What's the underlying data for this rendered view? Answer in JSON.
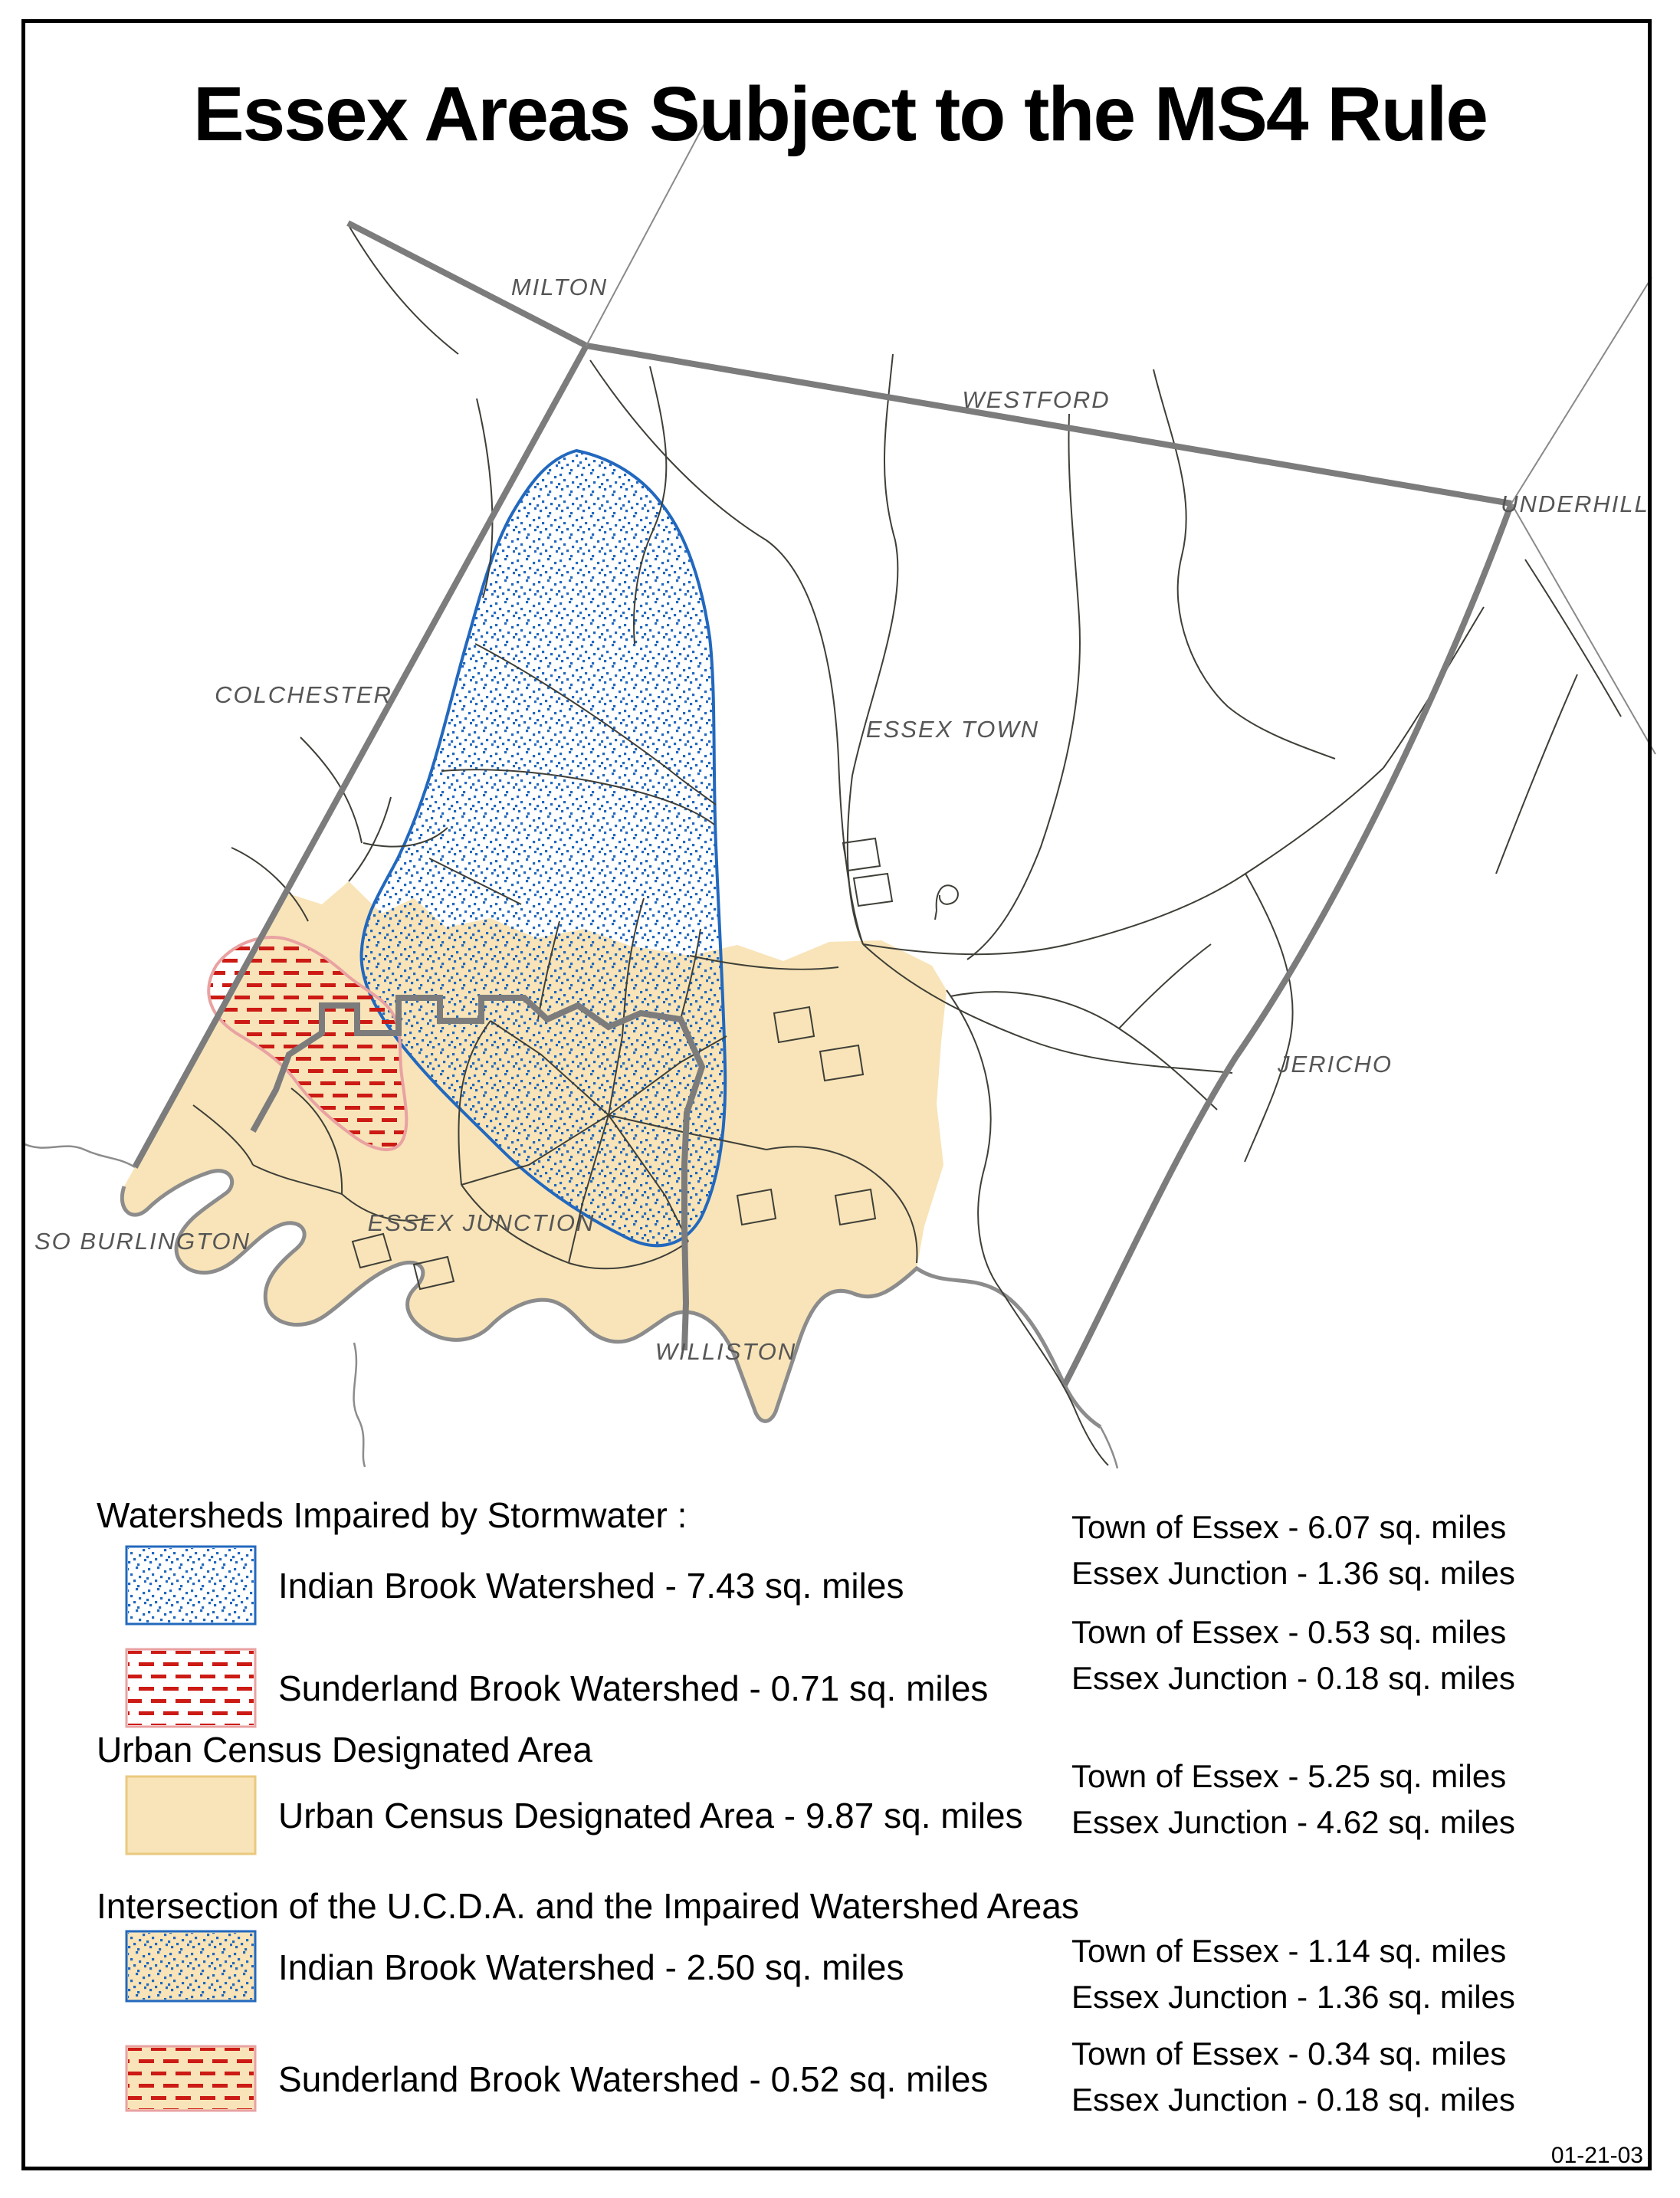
{
  "page": {
    "title": "Essex Areas Subject to the MS4 Rule",
    "date_stamp": "01-21-03"
  },
  "map": {
    "town_labels": [
      {
        "id": "milton",
        "text": "MILTON"
      },
      {
        "id": "westford",
        "text": "WESTFORD"
      },
      {
        "id": "underhill",
        "text": "UNDERHILL"
      },
      {
        "id": "colchester",
        "text": "COLCHESTER"
      },
      {
        "id": "essex-town",
        "text": "ESSEX TOWN"
      },
      {
        "id": "jericho",
        "text": "JERICHO"
      },
      {
        "id": "so-burlington",
        "text": "SO BURLINGTON"
      },
      {
        "id": "essex-junction",
        "text": "ESSEX JUNCTION"
      },
      {
        "id": "williston",
        "text": "WILLISTON"
      }
    ]
  },
  "legend": {
    "sections": [
      {
        "heading": "Watersheds Impaired by Stormwater :",
        "rows": [
          {
            "swatch": "indian-brook",
            "label": "Indian Brook Watershed - 7.43 sq. miles",
            "stats": [
              "Town of Essex - 6.07 sq. miles",
              "Essex Junction - 1.36 sq. miles"
            ]
          },
          {
            "swatch": "sunderland-brook",
            "label": "Sunderland Brook Watershed - 0.71 sq. miles",
            "stats": [
              "Town of Essex - 0.53 sq. miles",
              "Essex Junction - 0.18 sq. miles"
            ]
          }
        ]
      },
      {
        "heading": "Urban Census Designated Area",
        "rows": [
          {
            "swatch": "ucda",
            "label": "Urban Census Designated Area - 9.87 sq. miles",
            "stats": [
              "Town of Essex - 5.25 sq. miles",
              "Essex Junction - 4.62 sq. miles"
            ]
          }
        ]
      },
      {
        "heading": "Intersection of the U.C.D.A. and the Impaired Watershed Areas",
        "rows": [
          {
            "swatch": "ucda-indian-brook",
            "label": "Indian Brook Watershed - 2.50 sq. miles",
            "stats": [
              "Town of Essex - 1.14 sq. miles",
              "Essex Junction - 1.36 sq. miles"
            ]
          },
          {
            "swatch": "ucda-sunderland-brook",
            "label": "Sunderland Brook Watershed - 0.52 sq. miles",
            "stats": [
              "Town of Essex - 0.34 sq. miles",
              "Essex Junction - 0.18 sq. miles"
            ]
          }
        ]
      }
    ]
  },
  "colors": {
    "indian_brook_blue": "#2268BE",
    "sunderland_red": "#CC1A14",
    "sunderland_outline_pink": "#E9A2A2",
    "ucda_tan": "#F8E4B8",
    "boundary_gray": "#7C7C7C",
    "river_gray": "#8C8C8C",
    "road_gray": "#3F3F38",
    "label_gray": "#565656"
  }
}
